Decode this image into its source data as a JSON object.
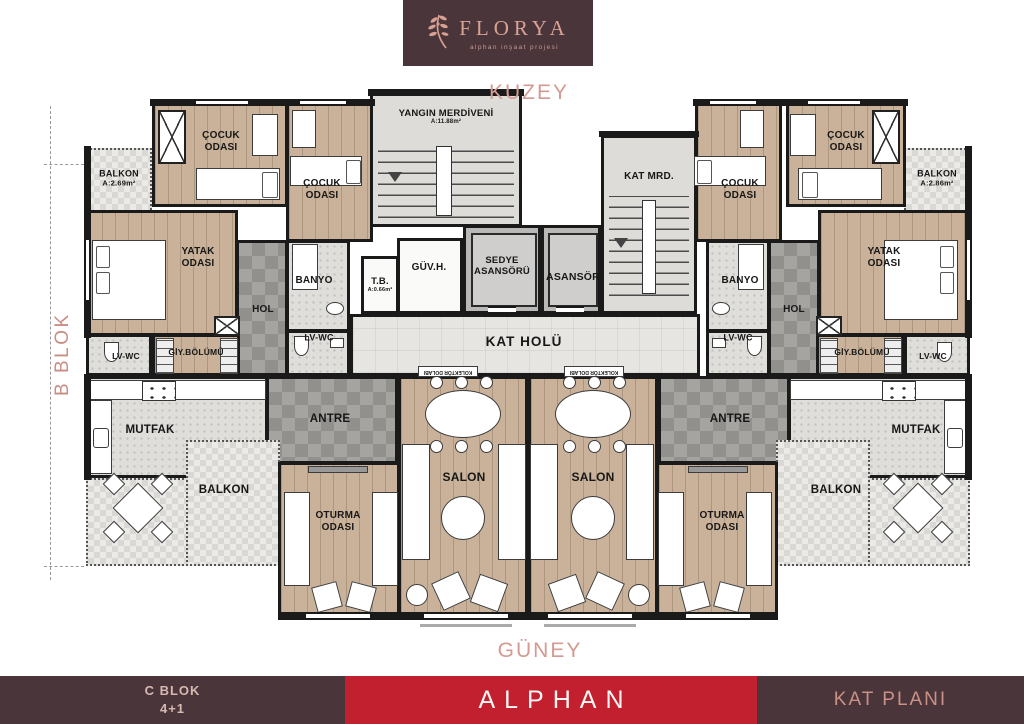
{
  "brand": {
    "logo_title": "FLORYA",
    "logo_subtitle": "alphan inşaat projesi"
  },
  "compass": {
    "north": "KUZEY",
    "south": "GÜNEY"
  },
  "side_label": "B BLOK",
  "footer": {
    "block": "C BLOK",
    "unit_type": "4+1",
    "brand": "ALPHAN",
    "sheet": "KAT PLANI"
  },
  "rooms": {
    "balkon": "BALKON",
    "balkon_tl_area": "A:2.69m²",
    "balkon_tr_area": "A:2.86m²",
    "cocuk_l1": "ÇOCUK",
    "cocuk_l2": "ODASI",
    "yatak_l1": "YATAK",
    "yatak_l2": "ODASI",
    "oturma_l1": "OTURMA",
    "oturma_l2": "ODASI",
    "salon": "SALON",
    "banyo": "BANYO",
    "hol": "HOL",
    "lv_wc": "LV-WC",
    "giy_bolumu": "GİY.BÖLÜMÜ",
    "mutfak": "MUTFAK",
    "antre": "ANTRE",
    "kat_holu": "KAT HOLÜ",
    "sedye_l1": "SEDYE",
    "sedye_l2": "ASANSÖRÜ",
    "asansor": "ASANSÖR",
    "guv_h": "GÜV.H.",
    "tb": "T.B.",
    "tb_area": "A:0.66m²",
    "yangin_merdiveni": "YANGIN MERDİVENİ",
    "yangin_area": "A:11.88m²",
    "kat_mrd": "KAT MRD.",
    "kolektor": "KOLEKTÖR DOLABI"
  },
  "colors": {
    "maroon": "#4a353b",
    "red": "#c2202e",
    "rose": "#d49a92",
    "wall": "#1a1a1a",
    "wood_floor": "#c9b299",
    "dark_tile": "#a6a4a1",
    "light_tile": "#e6e5e1"
  }
}
